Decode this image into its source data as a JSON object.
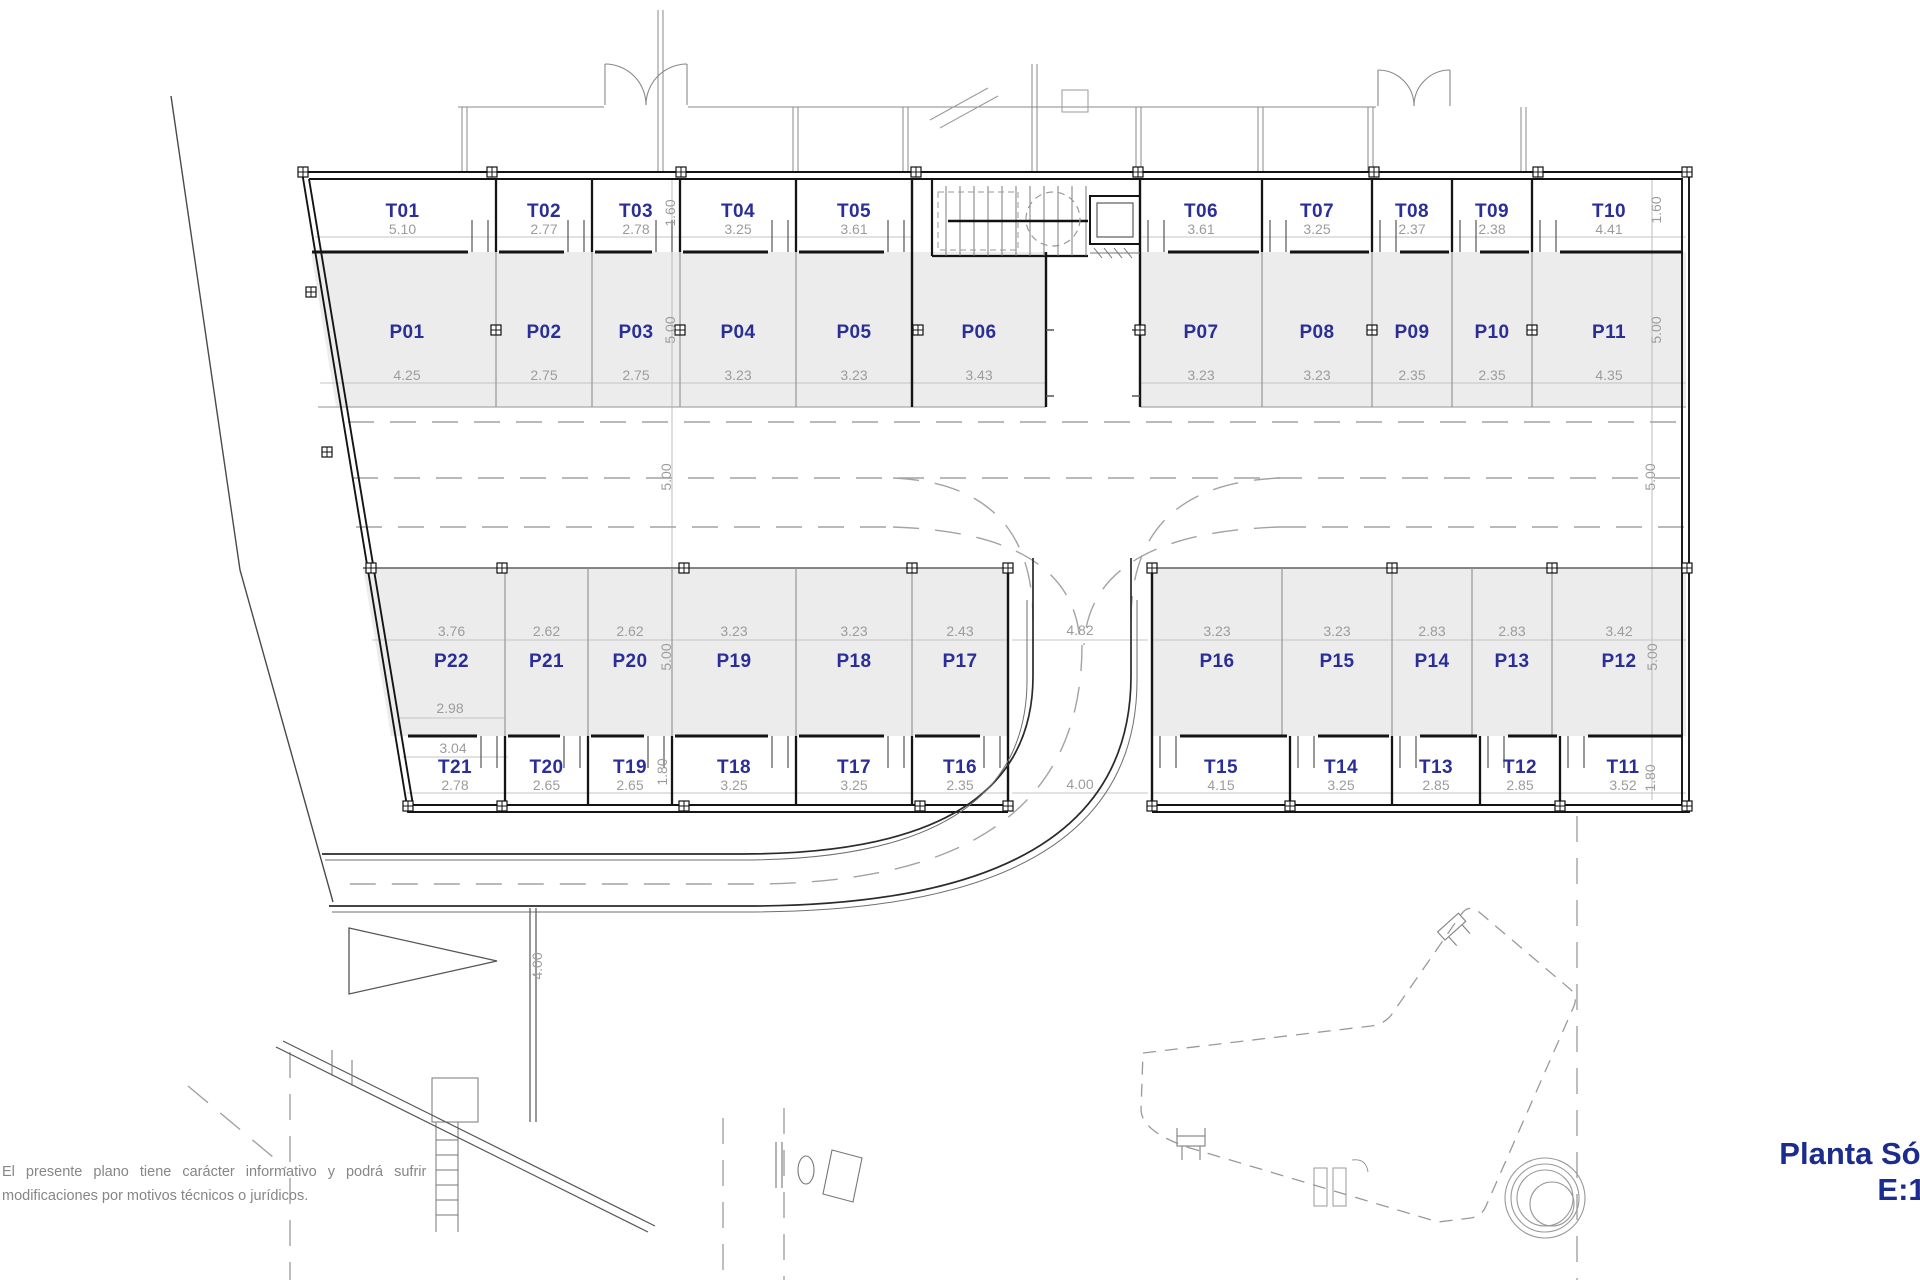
{
  "title": {
    "line1": "Planta Sótano",
    "line2": "E:1/150"
  },
  "disclaimer": {
    "line1": "El presente plano tiene carácter informativo y podrá sufrir",
    "line2": "modificaciones por motivos técnicos o jurídicos."
  },
  "colors": {
    "label": "#2b2e96",
    "dimension": "#9c9c9c",
    "stall_fill": "#ececec",
    "wall": "#141414",
    "title": "#1c2c8e"
  },
  "storage_top": [
    {
      "id": "T01",
      "dim": "5.10"
    },
    {
      "id": "T02",
      "dim": "2.77"
    },
    {
      "id": "T03",
      "dim": "2.78"
    },
    {
      "id": "T04",
      "dim": "3.25"
    },
    {
      "id": "T05",
      "dim": "3.61"
    },
    {
      "id": "T06",
      "dim": "3.61"
    },
    {
      "id": "T07",
      "dim": "3.25"
    },
    {
      "id": "T08",
      "dim": "2.37"
    },
    {
      "id": "T09",
      "dim": "2.38"
    },
    {
      "id": "T10",
      "dim": "4.41"
    }
  ],
  "parking_top": [
    {
      "id": "P01",
      "dim": "4.25"
    },
    {
      "id": "P02",
      "dim": "2.75"
    },
    {
      "id": "P03",
      "dim": "2.75"
    },
    {
      "id": "P04",
      "dim": "3.23"
    },
    {
      "id": "P05",
      "dim": "3.23"
    },
    {
      "id": "P06",
      "dim": "3.43"
    },
    {
      "id": "P07",
      "dim": "3.23"
    },
    {
      "id": "P08",
      "dim": "3.23"
    },
    {
      "id": "P09",
      "dim": "2.35"
    },
    {
      "id": "P10",
      "dim": "2.35"
    },
    {
      "id": "P11",
      "dim": "4.35"
    }
  ],
  "parking_bottom": [
    {
      "id": "P22",
      "dim": "3.76"
    },
    {
      "id": "P21",
      "dim": "2.62"
    },
    {
      "id": "P20",
      "dim": "2.62"
    },
    {
      "id": "P19",
      "dim": "3.23"
    },
    {
      "id": "P18",
      "dim": "3.23"
    },
    {
      "id": "P17",
      "dim": "2.43"
    },
    {
      "id": "P16",
      "dim": "3.23"
    },
    {
      "id": "P15",
      "dim": "3.23"
    },
    {
      "id": "P14",
      "dim": "2.83"
    },
    {
      "id": "P13",
      "dim": "2.83"
    },
    {
      "id": "P12",
      "dim": "3.42"
    }
  ],
  "storage_bottom": [
    {
      "id": "T21",
      "dim": "2.78"
    },
    {
      "id": "T20",
      "dim": "2.65"
    },
    {
      "id": "T19",
      "dim": "2.65"
    },
    {
      "id": "T18",
      "dim": "3.25"
    },
    {
      "id": "T17",
      "dim": "3.25"
    },
    {
      "id": "T16",
      "dim": "2.35"
    },
    {
      "id": "T15",
      "dim": "4.15"
    },
    {
      "id": "T14",
      "dim": "3.25"
    },
    {
      "id": "T13",
      "dim": "2.85"
    },
    {
      "id": "T12",
      "dim": "2.85"
    },
    {
      "id": "T11",
      "dim": "3.52"
    }
  ],
  "extra_dims": {
    "storage_top_depth": "1.60",
    "parking_top_depth": "5.00",
    "aisle_width": "5.00",
    "parking_bottom_depth": "5.00",
    "storage_bottom_depth": "1.80",
    "ramp_top_width": "4.82",
    "ramp_bottom_width": "4.00",
    "road_width": "4.00",
    "p22_rear_width": "2.98",
    "t21_rear_width": "3.04"
  }
}
